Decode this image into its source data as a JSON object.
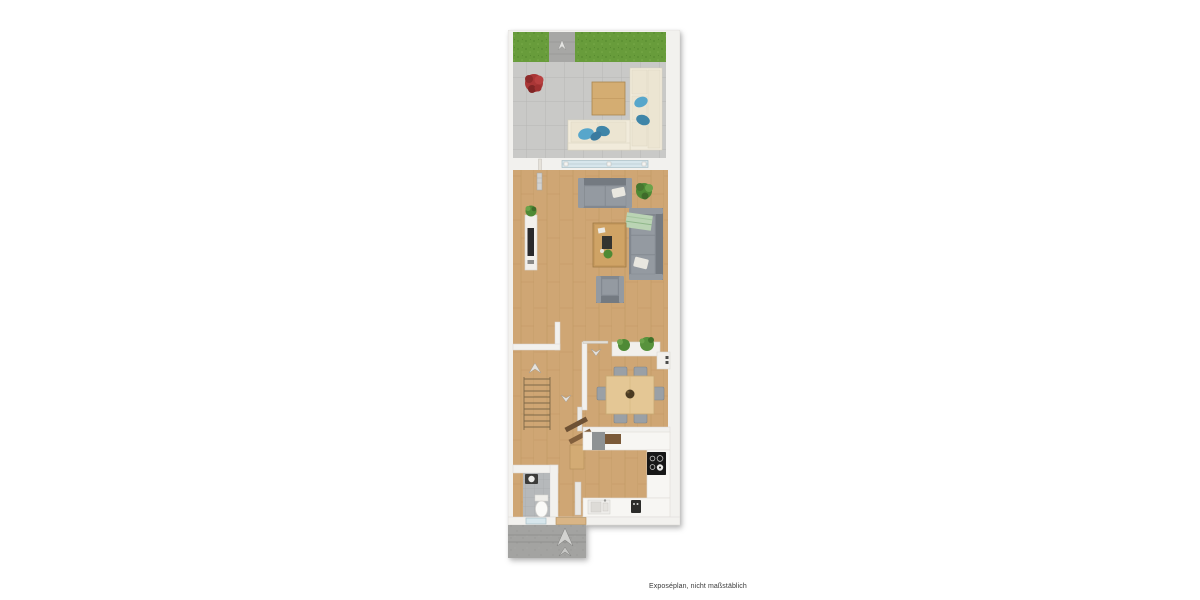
{
  "page": {
    "background": "#ffffff",
    "disclaimer": "Exposéplan, nicht maßstäblich"
  },
  "plan": {
    "kind": "floor-plan",
    "style": "top-down 3D real-estate exposé render, narrow townhouse level",
    "rooms": [
      "garden-strip",
      "terrace",
      "living-room",
      "hallway-with-stairs",
      "dining-area",
      "kitchen",
      "wc",
      "entrance"
    ],
    "items": {
      "garden": [
        "grass-patch-left",
        "grass-patch-right",
        "paved-path",
        "path-marker-icon"
      ],
      "terrace": [
        "red-plant",
        "outdoor-table",
        "l-shaped-outdoor-sofa",
        "blue-pillows"
      ],
      "terrace_wall": [
        "sliding-glass-door",
        "terrace-side-door"
      ],
      "living_room": [
        "radiator",
        "tv-sideboard",
        "potted-plant",
        "two-seat-sofa",
        "white-pillow",
        "three-seat-sofa",
        "green-blanket",
        "coffee-table",
        "armchair"
      ],
      "hallway": [
        "staircase",
        "stair-up-arrow-icon",
        "door-swing-icons",
        "partition-walls",
        "radiator"
      ],
      "dining": [
        "planter-sideboard",
        "tall-cabinet",
        "dining-table",
        "chairs"
      ],
      "kitchen": [
        "wall-shelves",
        "u-shaped-counter",
        "cooktop",
        "sink",
        "faucet-set",
        "radiator"
      ],
      "wc": [
        "washbasin",
        "toilet",
        "window"
      ],
      "entrance": [
        "entry-door",
        "concrete-steps",
        "entry-arrow-icons"
      ]
    }
  },
  "colors": {
    "background": "#ffffff",
    "text": "#3a3a3a",
    "wall": "#f2f1ee",
    "wall-edge": "#d9d7d3",
    "grass": "#689c3b",
    "grass-dark": "#578b2f",
    "grass-light": "#79ab49",
    "path": "#a7a7a5",
    "tile": "#c9c9c7",
    "tile-line": "#b3b3b1",
    "wood": "#cfa674",
    "wood-line": "#bd9560",
    "sofa-gray": "#82888f",
    "sofa-gray-dark": "#747a81",
    "cushion": "#949aa1",
    "cream": "#f1ebdb",
    "cream-cushion": "#ece5d2",
    "pillow-blue": "#57a6cb",
    "pillow-blue-dark": "#3f85a8",
    "plant-green": "#4e8a35",
    "plant-green-light": "#6aa34a",
    "plant-red": "#a93636",
    "table-wood": "#d4ad72",
    "coffee-wood": "#c79a5e",
    "dining-wood": "#e4c795",
    "chair-gray": "#9aa0a6",
    "counter": "#f7f6f3",
    "counter-edge": "#dfddd8",
    "appliance-black": "#171717",
    "concrete": "#a3a3a1",
    "concrete-line": "#8b8b89",
    "wc-tile": "#b6b9bb",
    "glass": "#d7e6ec",
    "glass-frame": "#a9bec7",
    "white-item": "#f2f0ec",
    "arrow": "#e5e2dc",
    "arrow-edge": "#a29d95",
    "shelf-wood": "#6e5134"
  }
}
